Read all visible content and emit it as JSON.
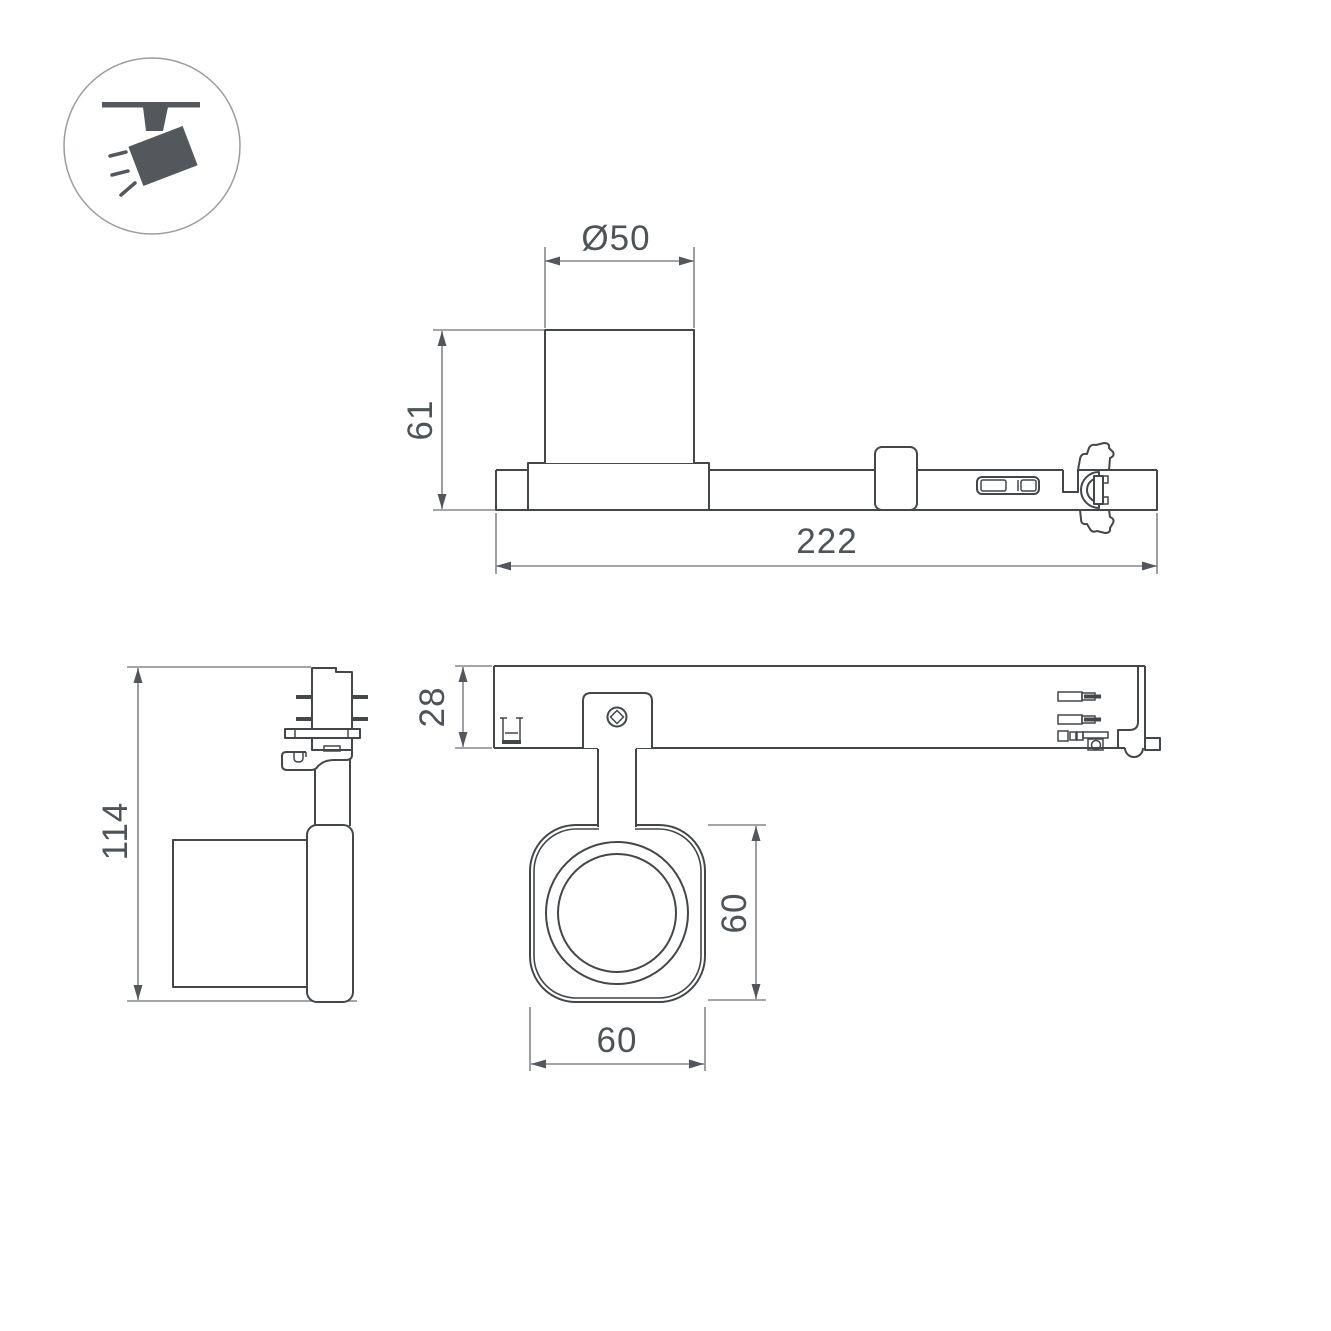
{
  "page": {
    "background": "#ffffff"
  },
  "colors": {
    "object_line": "#43474a",
    "dimension_line": "#84888c",
    "dimension_text": "#4e5357",
    "icon_fill": "#54585c",
    "icon_circle_stroke": "#989da0"
  },
  "icon": {
    "name": "ceiling-track-spotlight"
  },
  "dimensions": {
    "side_view": {
      "lamp_diameter": "Ø50",
      "lamp_height": "61",
      "track_length": "222"
    },
    "end_view": {
      "total_height": "114"
    },
    "front_view": {
      "track_bar_height": "28",
      "head_height": "60",
      "head_width": "60"
    }
  }
}
